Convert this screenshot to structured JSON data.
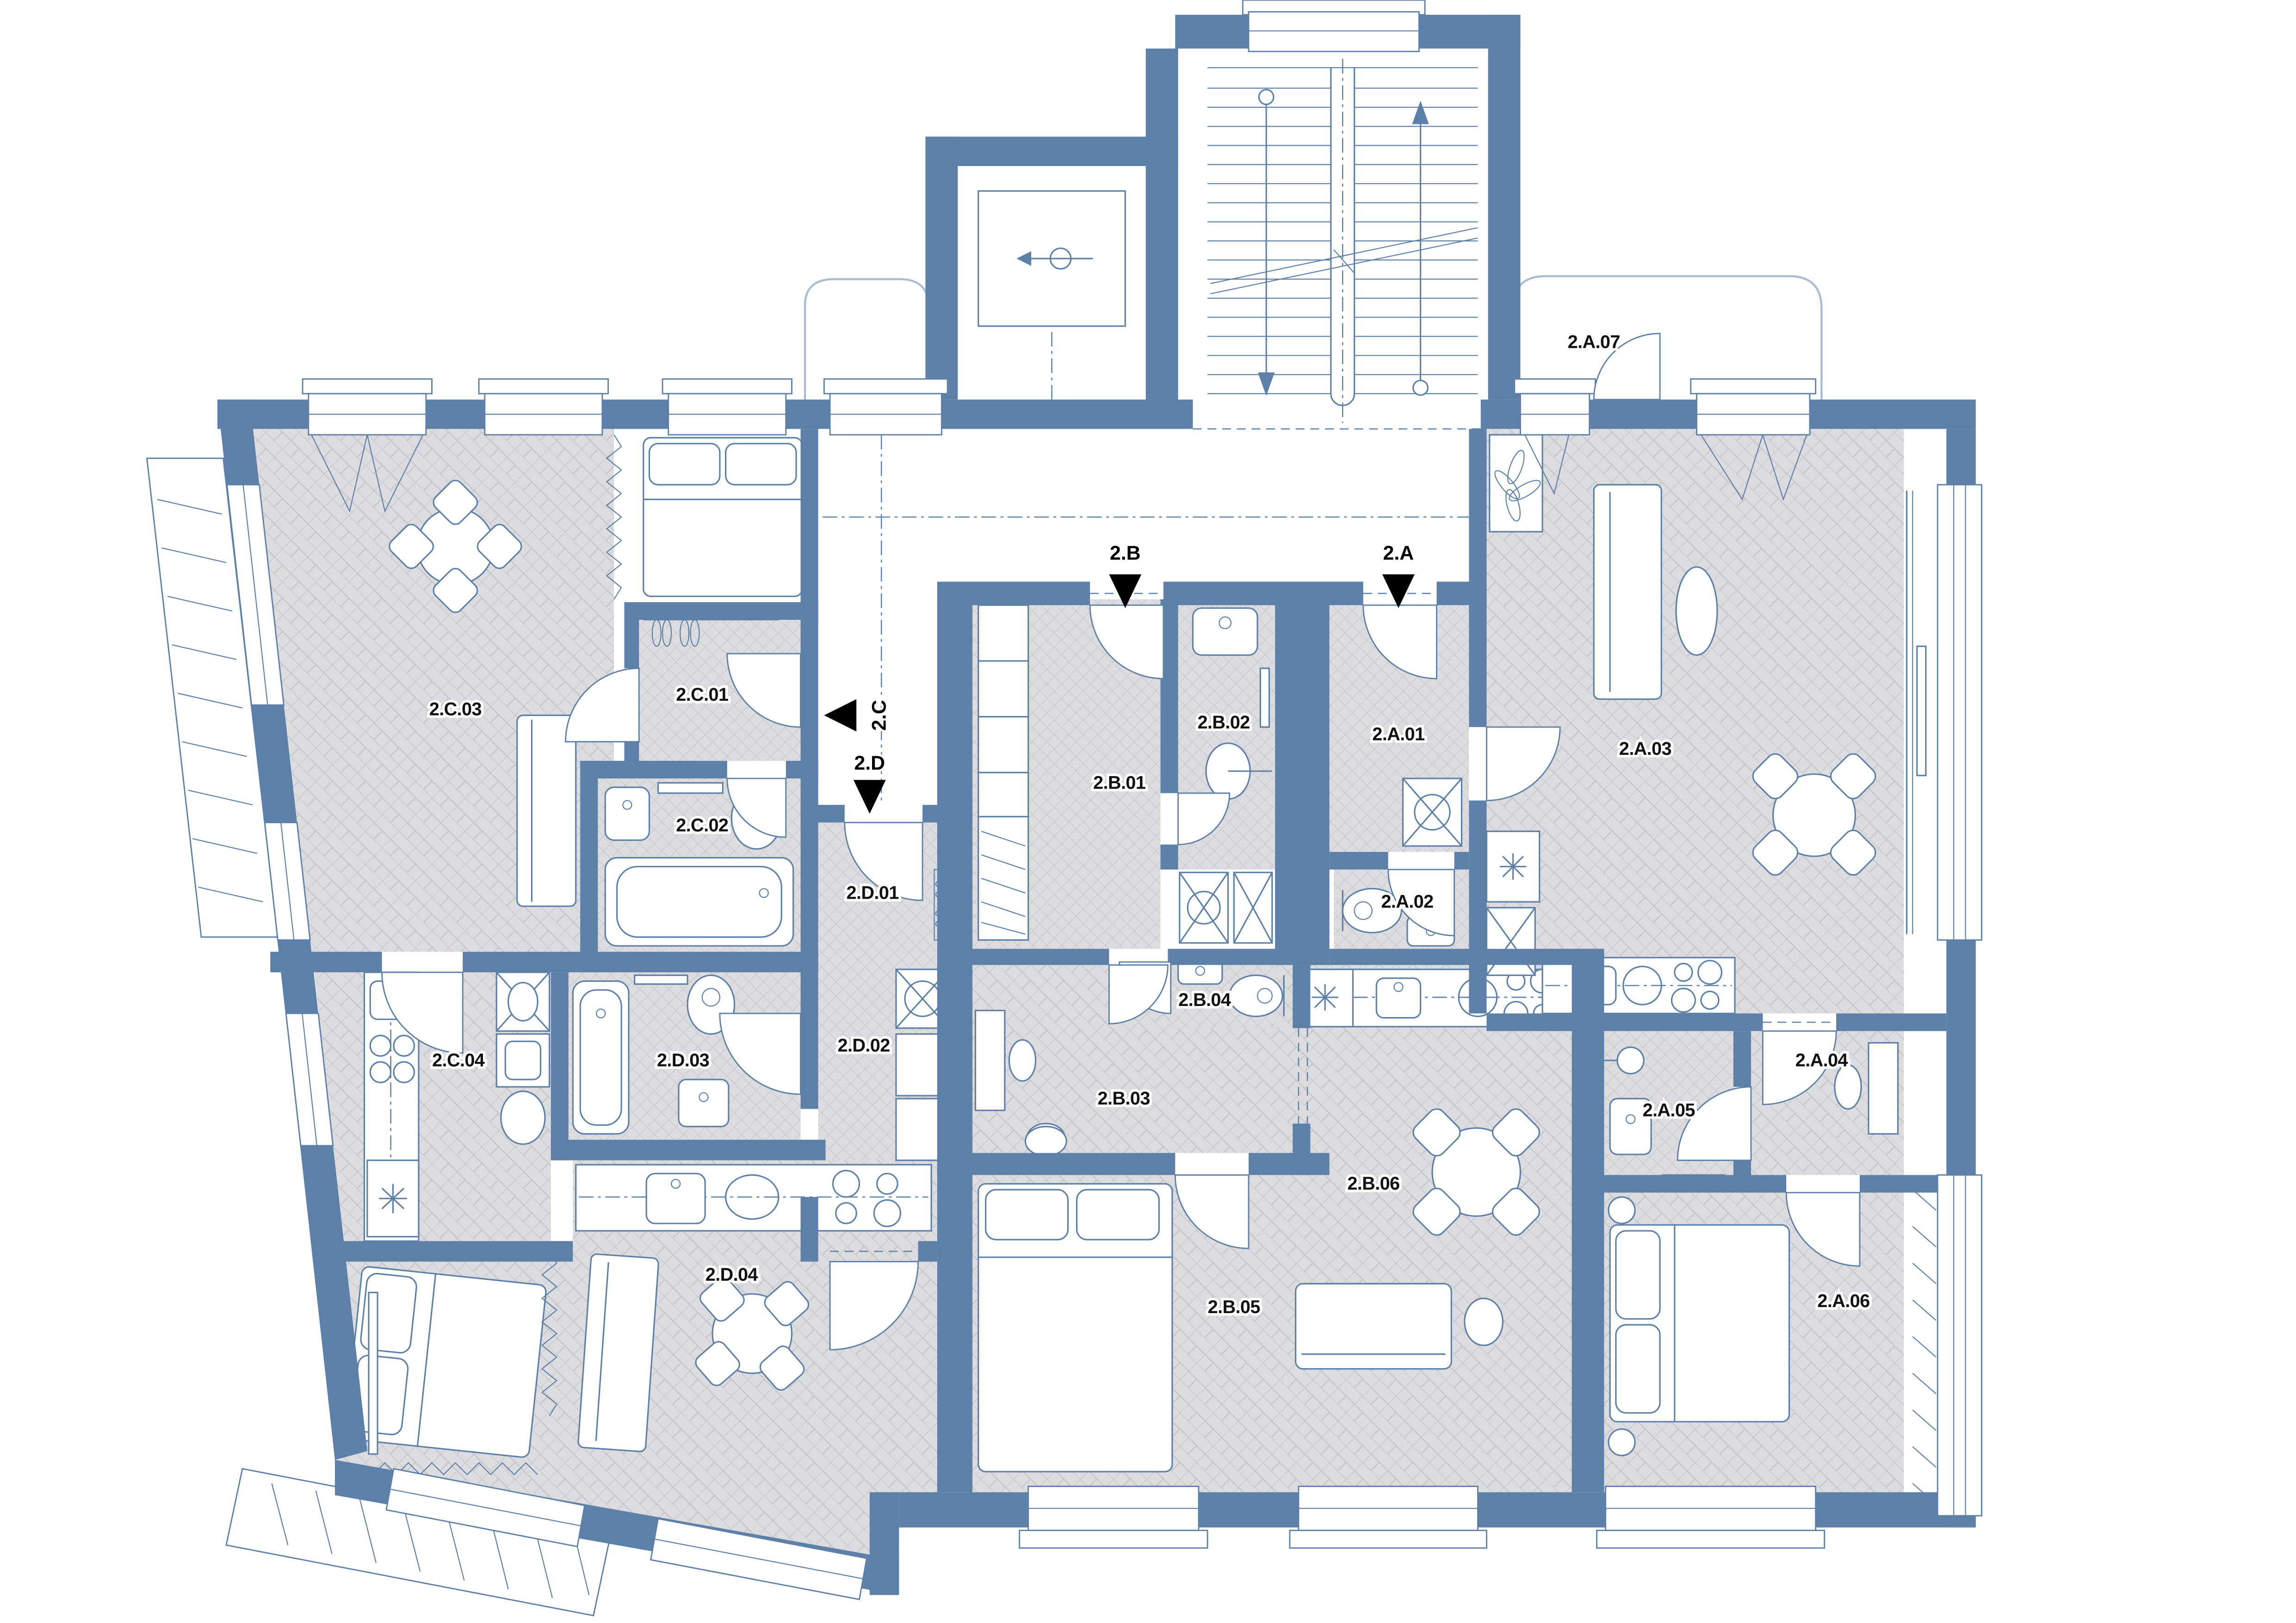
{
  "colors": {
    "wall": "#5d80a8",
    "floor": "#dcdcde",
    "floor_hatch": "#c6c6ca",
    "line": "#5d80a8",
    "label_text": "#111111",
    "marker": "#000000"
  },
  "rooms": {
    "c01": {
      "label": "2.C.01"
    },
    "c02": {
      "label": "2.C.02"
    },
    "c03": {
      "label": "2.C.03"
    },
    "c04": {
      "label": "2.C.04"
    },
    "d01": {
      "label": "2.D.01"
    },
    "d02": {
      "label": "2.D.02"
    },
    "d03": {
      "label": "2.D.03"
    },
    "d04": {
      "label": "2.D.04"
    },
    "b01": {
      "label": "2.B.01"
    },
    "b02": {
      "label": "2.B.02"
    },
    "b03": {
      "label": "2.B.03"
    },
    "b04": {
      "label": "2.B.04"
    },
    "b05": {
      "label": "2.B.05"
    },
    "b06": {
      "label": "2.B.06"
    },
    "a01": {
      "label": "2.A.01"
    },
    "a02": {
      "label": "2.A.02"
    },
    "a03": {
      "label": "2.A.03"
    },
    "a04": {
      "label": "2.A.04"
    },
    "a05": {
      "label": "2.A.05"
    },
    "a06": {
      "label": "2.A.06"
    },
    "a07": {
      "label": "2.A.07"
    }
  },
  "entrances": {
    "a": {
      "label": "2.A"
    },
    "b": {
      "label": "2.B"
    },
    "c": {
      "label": "2.C"
    },
    "d": {
      "label": "2.D"
    }
  }
}
